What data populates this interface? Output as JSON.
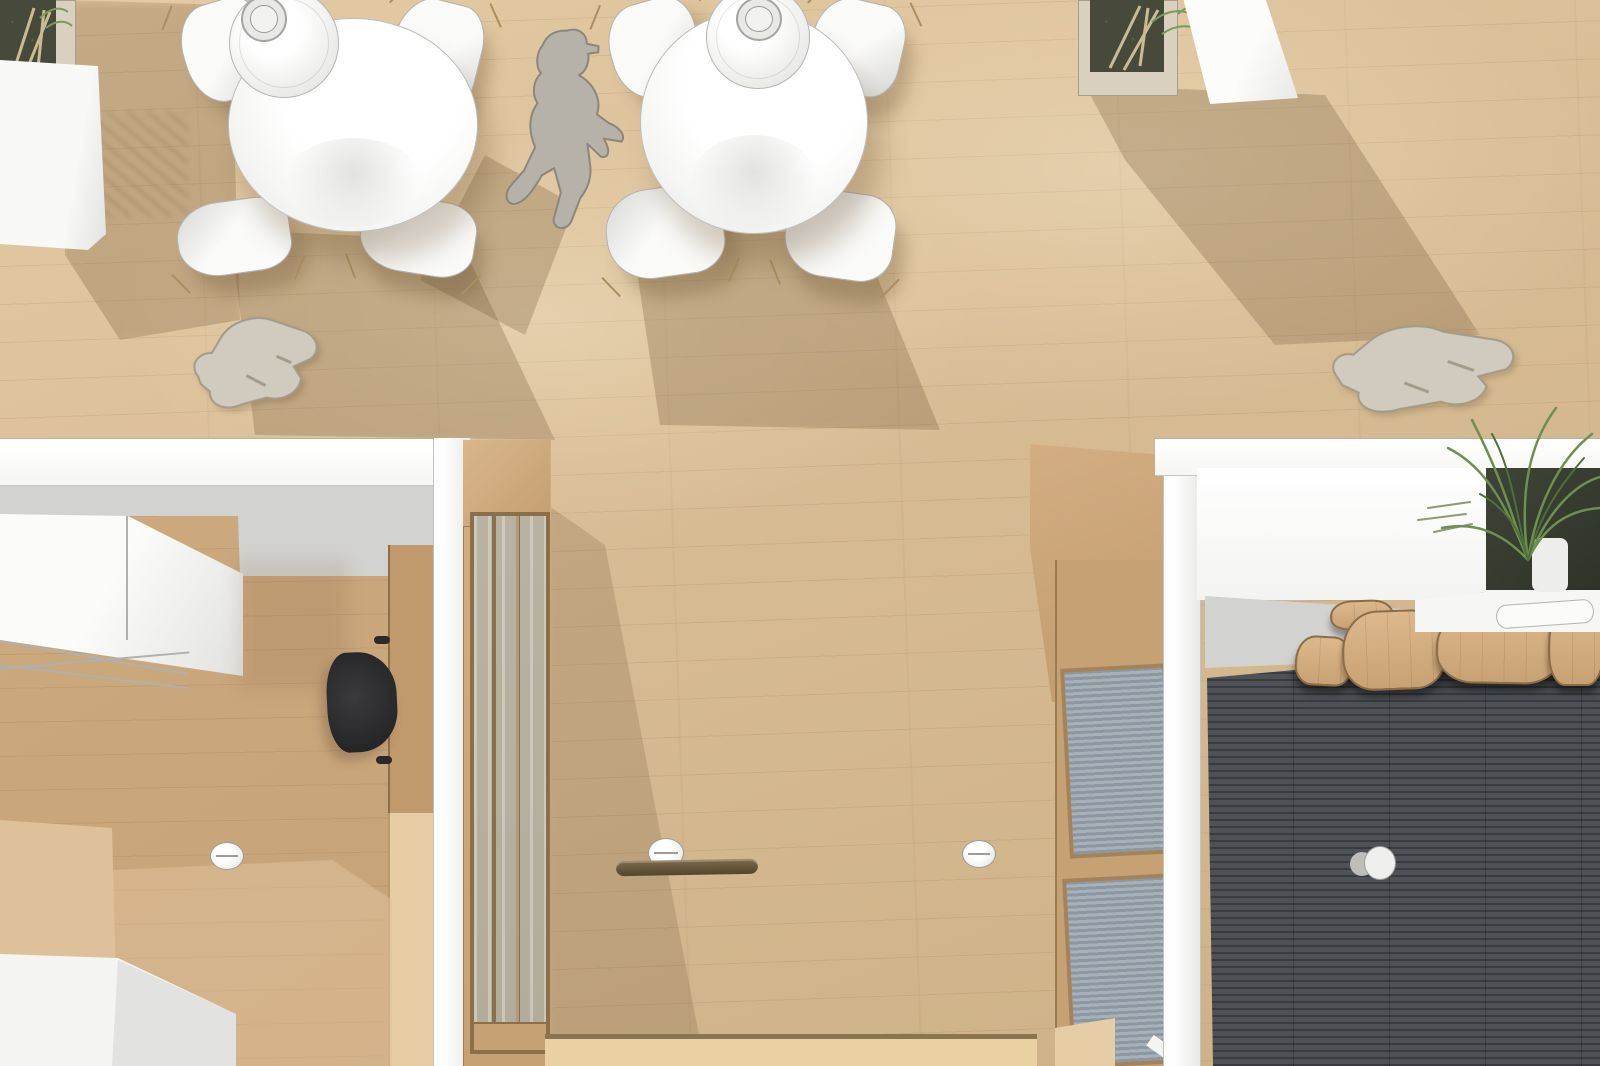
{
  "canvas": {
    "width": 1600,
    "height": 1066
  },
  "scene_type": "overhead-3d-interior-render",
  "colors": {
    "floor_upper": "#d7bb93",
    "floor_upper_light": "#e4cba4",
    "floor_hallway_light": "#e9d1a1",
    "floor_room_left": "#c6a278",
    "floor_room_left_light": "#dec19a",
    "wood_wall": "#c6a173",
    "wood_wall_top": "#d3ae82",
    "wood_wall_light": "#e7cda3",
    "wood_frame_line": "#8a6f49",
    "wall_white": "#f7f7f5",
    "wall_white_shade": "#e9e9e7",
    "wall_gray": "#d2d2d0",
    "line_gray": "#b3b3b1",
    "table_white": "#fdfdfb",
    "chair_shade": "#d6d6d4",
    "chair_leg": "#a98e5f",
    "lamp_ring": "#b5b5b3",
    "person_gray": "#b7b2a9",
    "person_outline": "#8c867c",
    "flat_person": "#d1cabe",
    "flat_person_outline": "#a39b89",
    "planter_frame": "#d9d0c0",
    "planter_soil": "#474a3a",
    "plant_green": "#7b9a5c",
    "plant_green_dark": "#4f6f3a",
    "twig_tan": "#cabb95",
    "glass_gray": "#b3ac9a",
    "louver_light": "#a7b1ba",
    "louver_dark": "#8b97a1",
    "dark_floor": "#4e5256",
    "dark_floor_line": "#383c40",
    "bench_wood_light": "#ddb88c",
    "bench_wood": "#c8a274",
    "bench_outline": "#8a6d46",
    "desk_wood": "#c09a6c",
    "chair_black_1": "#3a3a3c",
    "chair_black_2": "#1f1f21",
    "knob_white": "#efefed",
    "knob_gray": "#bdbdbb",
    "shelf_dark_1": "#7d6a49",
    "shelf_dark_2": "#52452f",
    "threshold": "#8a7452",
    "shadow_soft": "rgba(104,78,48,0.26)",
    "shadow_strong": "rgba(96,70,42,0.34)",
    "sun_patch": "rgba(255,246,224,0.28)"
  },
  "objects": [
    "wood-plank-floor",
    "round-dining-table",
    "dining-chair",
    "pendant-lamp",
    "standing-person-silhouette",
    "flattened-person-silhouette",
    "planter-box",
    "white-partition",
    "white-bench",
    "office-room",
    "white-cabinet",
    "wood-desk-panel",
    "black-office-chair",
    "glazed-wood-door",
    "wall-knob-light",
    "floating-shelf",
    "louver-window",
    "terrace-room",
    "dark-deck-floor",
    "wood-bench-row",
    "white-counter",
    "fern-plant",
    "deck-light-fixture"
  ]
}
